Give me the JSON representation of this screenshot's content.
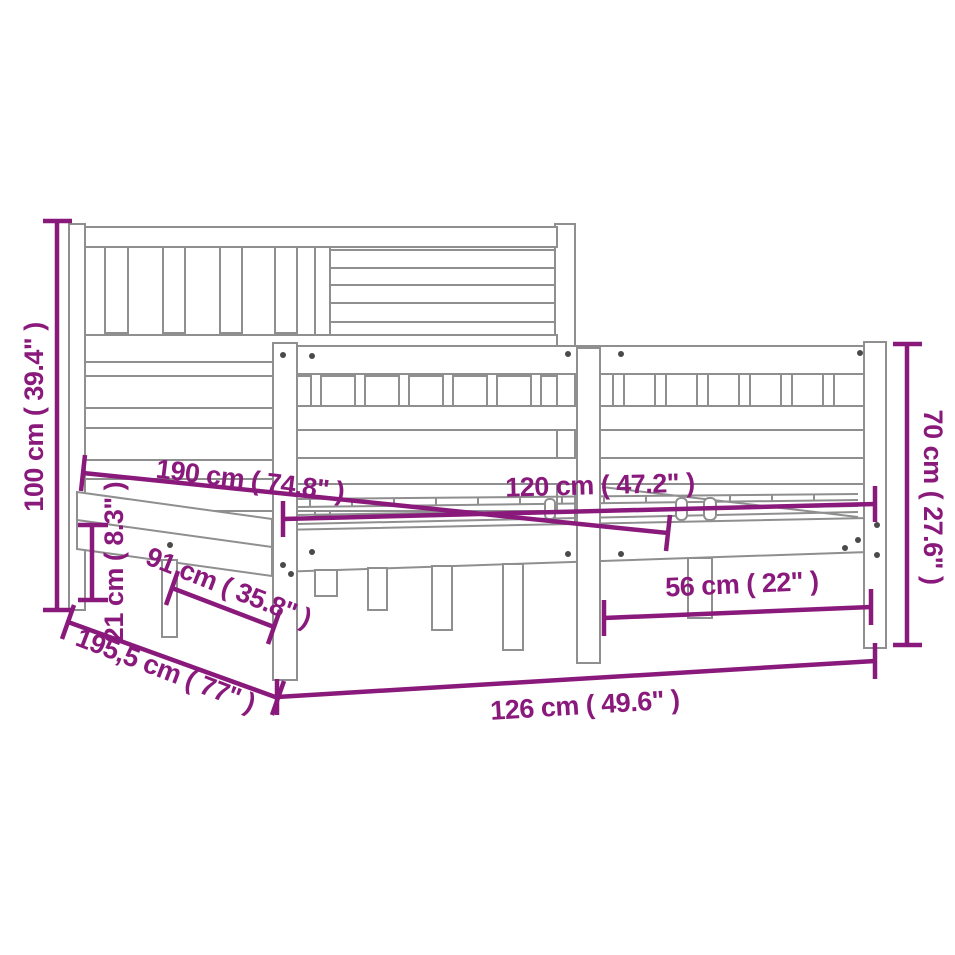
{
  "diagram": {
    "type": "product-dimension-diagram",
    "subject": "bed-frame-line-drawing",
    "colors": {
      "dimension_accent": "#8a197c",
      "outline_gray": "#8f8f8f",
      "screw_dot": "#4a4a4a",
      "background": "#ffffff"
    },
    "dimensions": [
      {
        "id": "headboard-height",
        "label": "100 cm ( 39.4\" )"
      },
      {
        "id": "inner-length",
        "label": "190 cm ( 74.8\" )"
      },
      {
        "id": "rail-height",
        "label": "21 cm ( 8.3\" )"
      },
      {
        "id": "under-bed-length",
        "label": "91 cm ( 35.8\" )"
      },
      {
        "id": "outer-length",
        "label": "195,5 cm ( 77\" )"
      },
      {
        "id": "outer-width",
        "label": "126 cm ( 49.6\" )"
      },
      {
        "id": "inner-width",
        "label": "120 cm ( 47.2\" )"
      },
      {
        "id": "leg-span",
        "label": "56 cm ( 22\" )"
      },
      {
        "id": "footboard-height",
        "label": "70 cm ( 27.6\" )"
      }
    ]
  }
}
